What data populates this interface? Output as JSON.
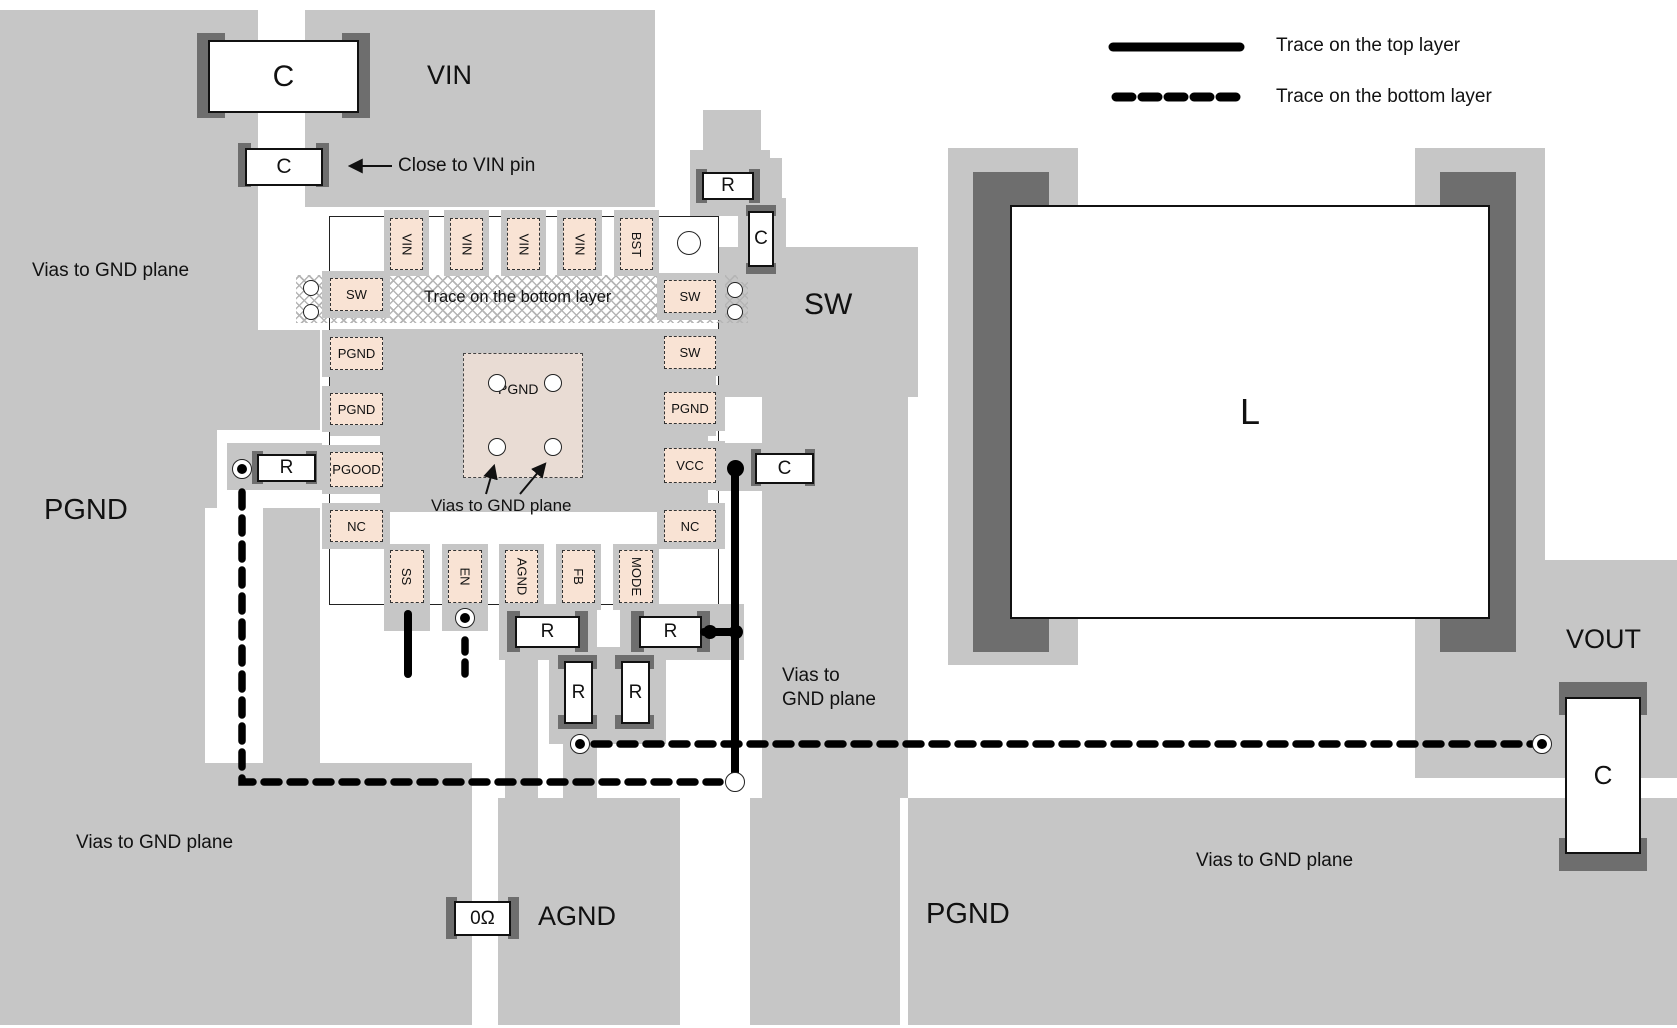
{
  "colors": {
    "plane": "#c6c6c6",
    "pad_dark": "#6e6e6e",
    "pin_fill": "#f9e3d4",
    "center_pad_fill": "#e9dcd4",
    "trace": "#000000"
  },
  "legend": {
    "top": {
      "style": "solid",
      "label": "Trace on the top layer"
    },
    "bottom": {
      "style": "dashed",
      "label": "Trace on the bottom layer"
    }
  },
  "net_labels": {
    "vin": "VIN",
    "sw": "SW",
    "pgnd_left": "PGND",
    "pgnd_bottom": "PGND",
    "agnd": "AGND",
    "vout": "VOUT"
  },
  "annotations": {
    "close_to_vin": "Close to VIN pin",
    "trace_bottom_layer": "Trace on the bottom layer",
    "vias_gnd_top_left": "Vias to GND plane",
    "vias_gnd_bottom_left": "Vias to GND plane",
    "vias_gnd_bottom_right": "Vias to GND plane",
    "vias_gnd_ic": "Vias to GND plane",
    "vias_gnd_right_line1": "Vias to",
    "vias_gnd_right_line2": "GND plane"
  },
  "ic": {
    "pins": {
      "top": [
        "VIN",
        "VIN",
        "VIN",
        "VIN",
        "BST"
      ],
      "left": [
        "SW",
        "PGND",
        "PGND",
        "PGOOD",
        "NC"
      ],
      "right": [
        "SW",
        "SW",
        "PGND",
        "VCC",
        "NC"
      ],
      "bottom": [
        "SS",
        "EN",
        "AGND",
        "FB",
        "MODE"
      ]
    },
    "center_pad": "PGND"
  },
  "components": {
    "c_input_bulk": "C",
    "c_input_close": "C",
    "r_bst": "R",
    "c_bst": "C",
    "r_pgood": "R",
    "c_vcc": "C",
    "r_feedback_top": "R",
    "r_mode": "R",
    "r_feedback_left": "R",
    "r_feedback_right": "R",
    "r_zero_ohm": "0Ω",
    "c_output": "C",
    "inductor": "L"
  },
  "via_grids": [
    {
      "name": "gnd-vias-top-left",
      "x": 90,
      "y": 72,
      "cols": 3,
      "rows": 6,
      "dx": 27,
      "dy": 27.6,
      "r": 8
    },
    {
      "name": "gnd-vias-mid-left",
      "x": 163,
      "y": 358,
      "cols": 6,
      "rows": 3,
      "dx": 28.5,
      "dy": 25.5,
      "r": 8.5
    },
    {
      "name": "gnd-vias-bottom-left",
      "x": 109,
      "y": 880,
      "cols": 5,
      "rows": 3,
      "dx": 27,
      "dy": 26,
      "r": 8.5
    },
    {
      "name": "gnd-vias-right",
      "x": 808,
      "y": 597,
      "cols": 3,
      "rows": 3,
      "dx": 27,
      "dy": 27,
      "r": 8.5
    },
    {
      "name": "gnd-vias-bottom-right",
      "x": 1108,
      "y": 905,
      "cols": 20,
      "rows": 2,
      "dx": 26.3,
      "dy": 28,
      "r": 8.5
    }
  ]
}
